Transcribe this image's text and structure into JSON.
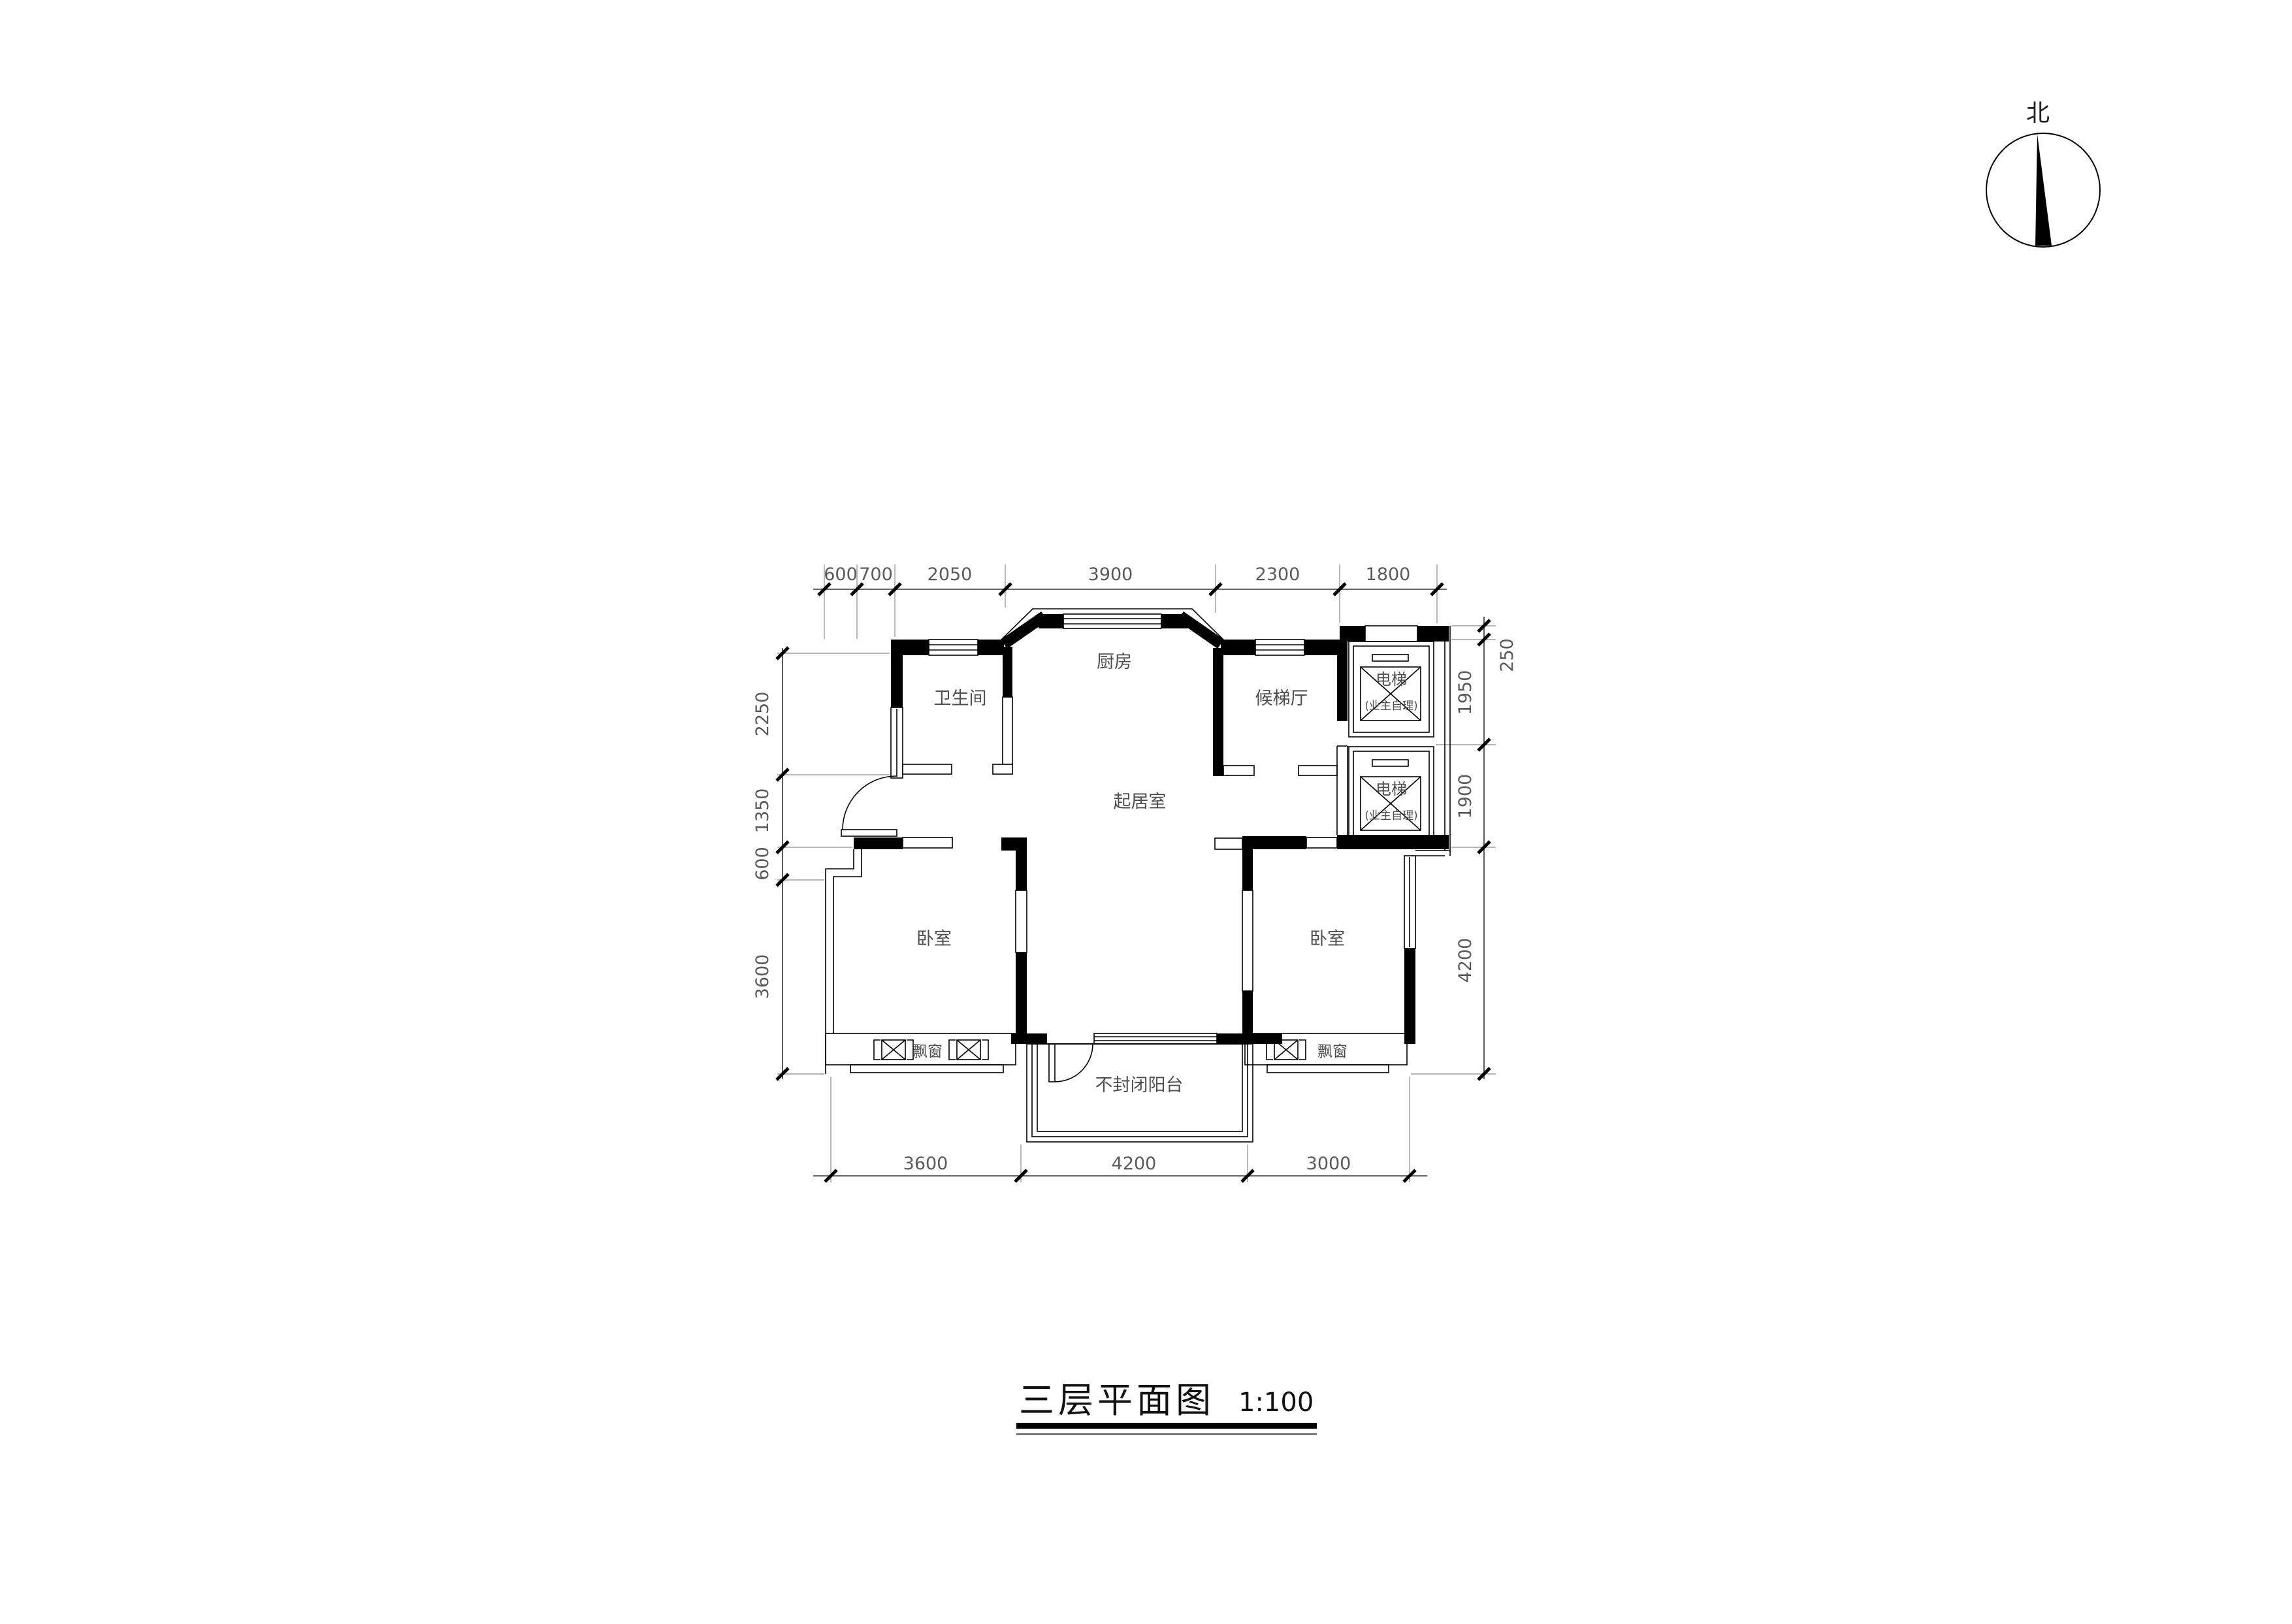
{
  "north": {
    "label": "北"
  },
  "title": {
    "text": "三层平面图",
    "scale": "1:100"
  },
  "rooms": {
    "bathroom": "卫生间",
    "kitchen": "厨房",
    "elevator_hall": "候梯厅",
    "living_room": "起居室",
    "bedroom_left": "卧室",
    "bedroom_right": "卧室",
    "balcony": "不封闭阳台",
    "bay_window_left": "飘窗",
    "bay_window_right": "飘窗",
    "elevator_upper": "电梯",
    "elevator_upper_note": "(业主自理)",
    "elevator_lower": "电梯",
    "elevator_lower_note": "(业主自理)"
  },
  "dimensions": {
    "top": [
      "600",
      "700",
      "2050",
      "3900",
      "2300",
      "1800"
    ],
    "right": [
      "250",
      "1950",
      "1900",
      "4200"
    ],
    "left": [
      "2250",
      "1350",
      "600",
      "3600"
    ],
    "bottom": [
      "3600",
      "4200",
      "3000"
    ]
  }
}
